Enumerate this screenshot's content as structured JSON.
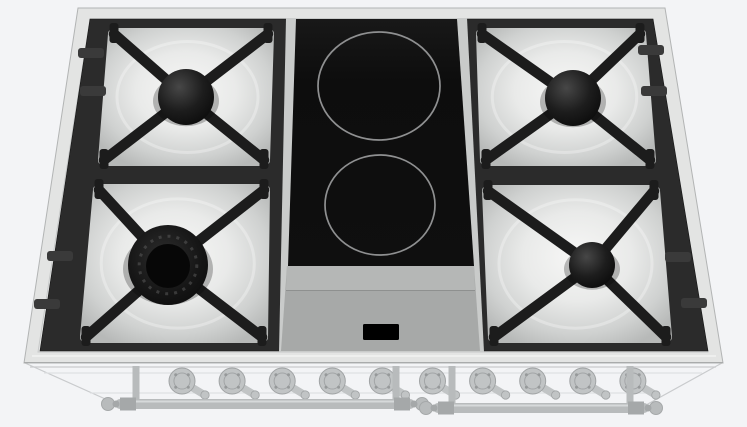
{
  "scene": {
    "type": "3d-product-render",
    "subject": "90cm dual-fuel range cooktop viewed from above: 4 gas burners with black cast-iron grates on white enamel drip trays, central black ceramic section with 2 induction zones, control display, 10 front control knobs and two door handle rails on the ghosted oven body below",
    "background_color": "#f3f4f6"
  },
  "colors": {
    "background": "#f3f4f6",
    "rim": "#e3e4e3",
    "rim_edge": "#b2b4b4",
    "rim_inner_line": "#c7c9c9",
    "frame": "#2b2b2b",
    "frame_tab": "#3a3a3a",
    "grate": "#1c1c1c",
    "tray_center": "#f6f6f5",
    "tray_edge": "#b7b9b8",
    "glass": "#0e0e0e",
    "zone_ring": "#8f9091",
    "panel": "#a7a9a8",
    "panel_light": "#b5b7b6",
    "panel_seam": "#8e908f",
    "display": "#000000",
    "center_surround": "#c9cbca",
    "knob": "#bdc0c1",
    "knob_edge": "#9a9d9e",
    "knob_detail": "#8f9293",
    "ghost": "#c6c8ca",
    "ghost_light": "#dddfe1",
    "rail": "#b4b7b8",
    "rail_edge": "#9fa2a3"
  },
  "cooktop": {
    "gas_burners": [
      {
        "id": "rear-left",
        "label": "rear left gas burner",
        "cx": 186,
        "cy": 97,
        "cap_r": 28,
        "type": "standard",
        "tray": [
          [
            114,
            34
          ],
          [
            268,
            34
          ],
          [
            264,
            160
          ],
          [
            104,
            160
          ]
        ]
      },
      {
        "id": "front-left",
        "label": "front left wok burner",
        "cx": 168,
        "cy": 265,
        "cap_r": 40,
        "type": "wok",
        "tray": [
          [
            99,
            190
          ],
          [
            264,
            190
          ],
          [
            262,
            337
          ],
          [
            86,
            337
          ]
        ]
      },
      {
        "id": "rear-right",
        "label": "rear right gas burner",
        "cx": 573,
        "cy": 98,
        "cap_r": 28,
        "type": "standard",
        "tray": [
          [
            482,
            34
          ],
          [
            640,
            34
          ],
          [
            650,
            160
          ],
          [
            486,
            160
          ]
        ]
      },
      {
        "id": "front-right",
        "label": "front right gas burner",
        "cx": 592,
        "cy": 265,
        "cap_r": 23,
        "type": "standard",
        "tray": [
          [
            488,
            191
          ],
          [
            654,
            191
          ],
          [
            666,
            337
          ],
          [
            494,
            337
          ]
        ]
      }
    ],
    "induction_zones": [
      {
        "id": "rear-center",
        "label": "rear induction zone",
        "cx": 379,
        "cy": 86,
        "rx": 61,
        "ry": 54
      },
      {
        "id": "front-center",
        "label": "front induction zone",
        "cx": 380,
        "cy": 205,
        "rx": 55,
        "ry": 50
      }
    ],
    "display": {
      "x": 363,
      "y": 324,
      "w": 36,
      "h": 16
    },
    "knobs": {
      "count": 10,
      "x_start": 182,
      "x_step": 50.1,
      "y": 381,
      "r": 13
    },
    "rails": [
      {
        "x1": 120,
        "x2": 410,
        "y": 404,
        "brackets": [
          136,
          396
        ]
      },
      {
        "x1": 438,
        "x2": 644,
        "y": 408,
        "brackets": [
          452,
          630
        ]
      }
    ],
    "frame_tabs": [
      {
        "x": 91,
        "y": 53
      },
      {
        "x": 93,
        "y": 91
      },
      {
        "x": 60,
        "y": 256
      },
      {
        "x": 47,
        "y": 304
      },
      {
        "x": 651,
        "y": 50
      },
      {
        "x": 654,
        "y": 91
      },
      {
        "x": 678,
        "y": 257
      },
      {
        "x": 694,
        "y": 303
      }
    ]
  }
}
